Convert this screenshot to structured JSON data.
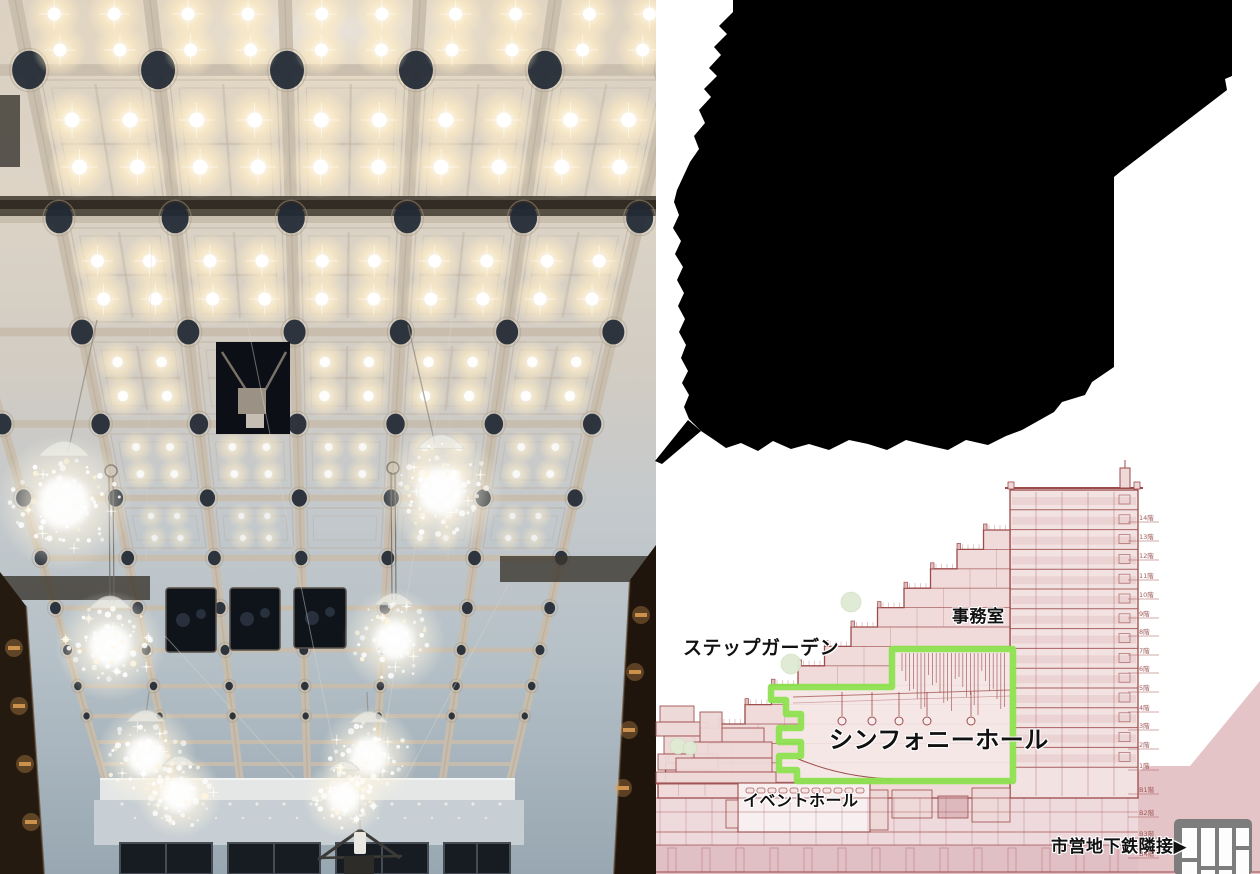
{
  "window": {
    "width": 1260,
    "height": 874
  },
  "photo": {
    "colors": {
      "ceiling_warm": "#e2d8ca",
      "ceiling_cool": "#b9c3ca",
      "beam": "#c8bdac",
      "light_glow": "#ffedc6",
      "medallion": "#1f2833",
      "balcony_wood": "#241a10",
      "balcony_light": "#d89a52"
    }
  },
  "silhouette": {
    "color": "#000000"
  },
  "diagram": {
    "labels": {
      "step_garden": "ステップガーデン",
      "office": "事務室",
      "symphony_hall": "シンフォニーホール",
      "event_hall": "イベントホール",
      "subway_note": "市営地下鉄隣接",
      "subway_arrow": "▶"
    },
    "floor_labels": [
      "14階",
      "13階",
      "12階",
      "11階",
      "10階",
      "9階",
      "8階",
      "7階",
      "6階",
      "5階",
      "4階",
      "3階",
      "2階",
      "1階",
      "B1階",
      "B2階",
      "B3階",
      "B4階"
    ],
    "colors": {
      "line": "#9c4a4a",
      "line_light": "#c08585",
      "fill_light": "#f3e2e2",
      "fill_mid": "#eed8d8",
      "ground": "#e5c4c7",
      "underground": "#e0bcc0",
      "highlight_green": "#8de24f",
      "tree_green": "#dfead3",
      "label_text": "#111111",
      "floor_label": "#a05a5a",
      "icon_gray": "#7d7d7d"
    }
  }
}
